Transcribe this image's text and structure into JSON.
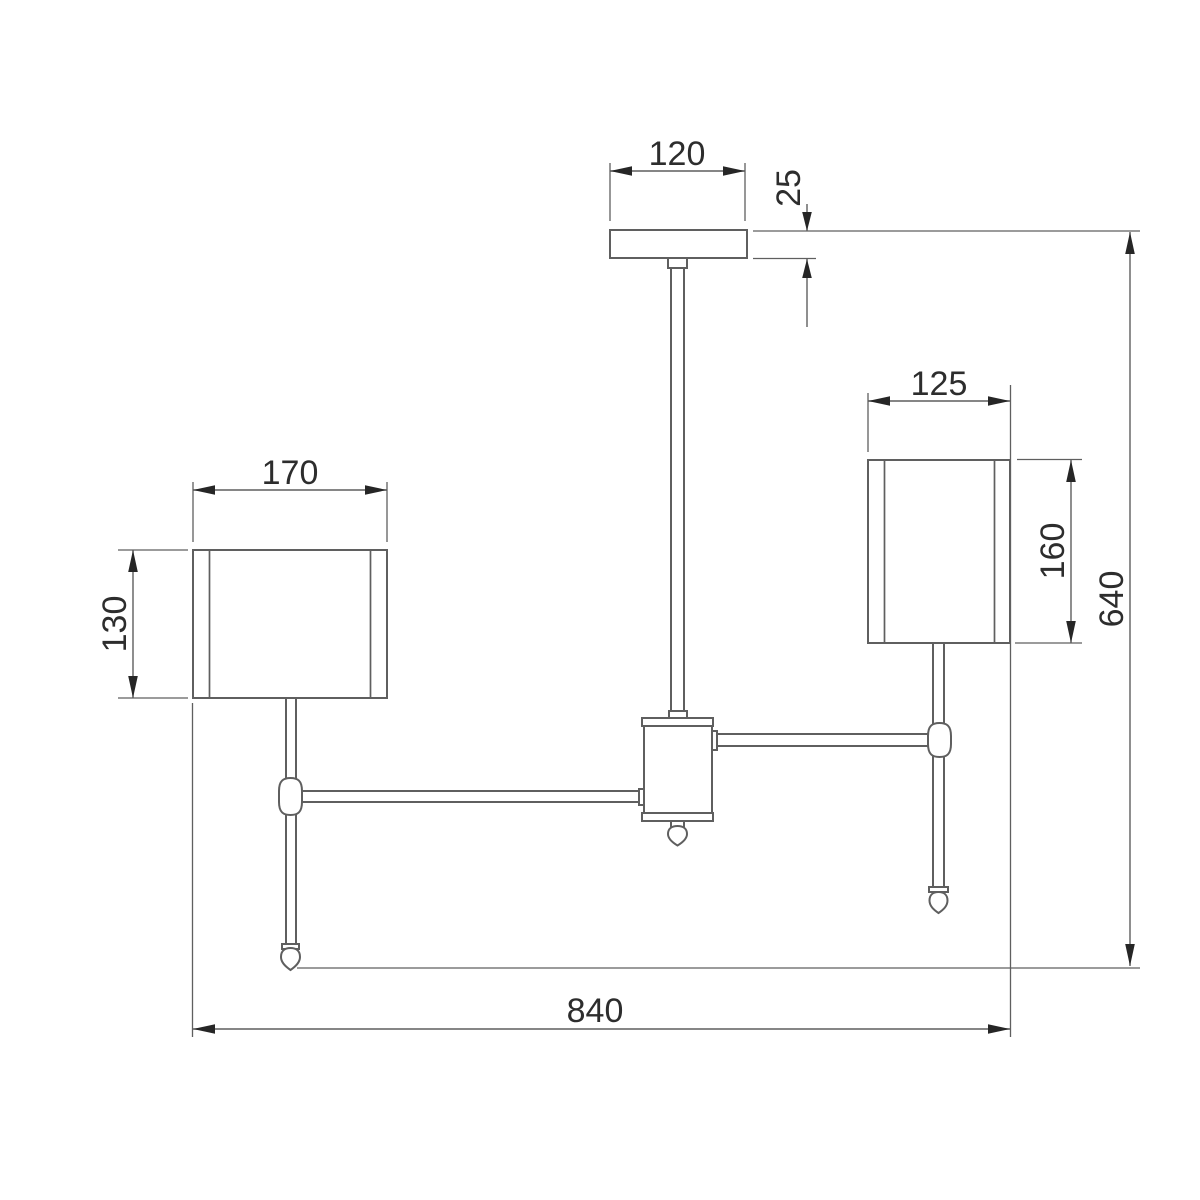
{
  "drawing": {
    "background": "#ffffff",
    "line_color": "#5f5f5f",
    "arrow_color": "#262626",
    "text_color": "#2d2d2d"
  },
  "dimensions": {
    "canopy_width": {
      "value": "120"
    },
    "canopy_height": {
      "value": "25"
    },
    "left_shade_width": {
      "value": "170"
    },
    "left_shade_height": {
      "value": "130"
    },
    "right_shade_width": {
      "value": "125"
    },
    "right_shade_height": {
      "value": "160"
    },
    "overall_height": {
      "value": "640"
    },
    "overall_width": {
      "value": "840"
    }
  }
}
